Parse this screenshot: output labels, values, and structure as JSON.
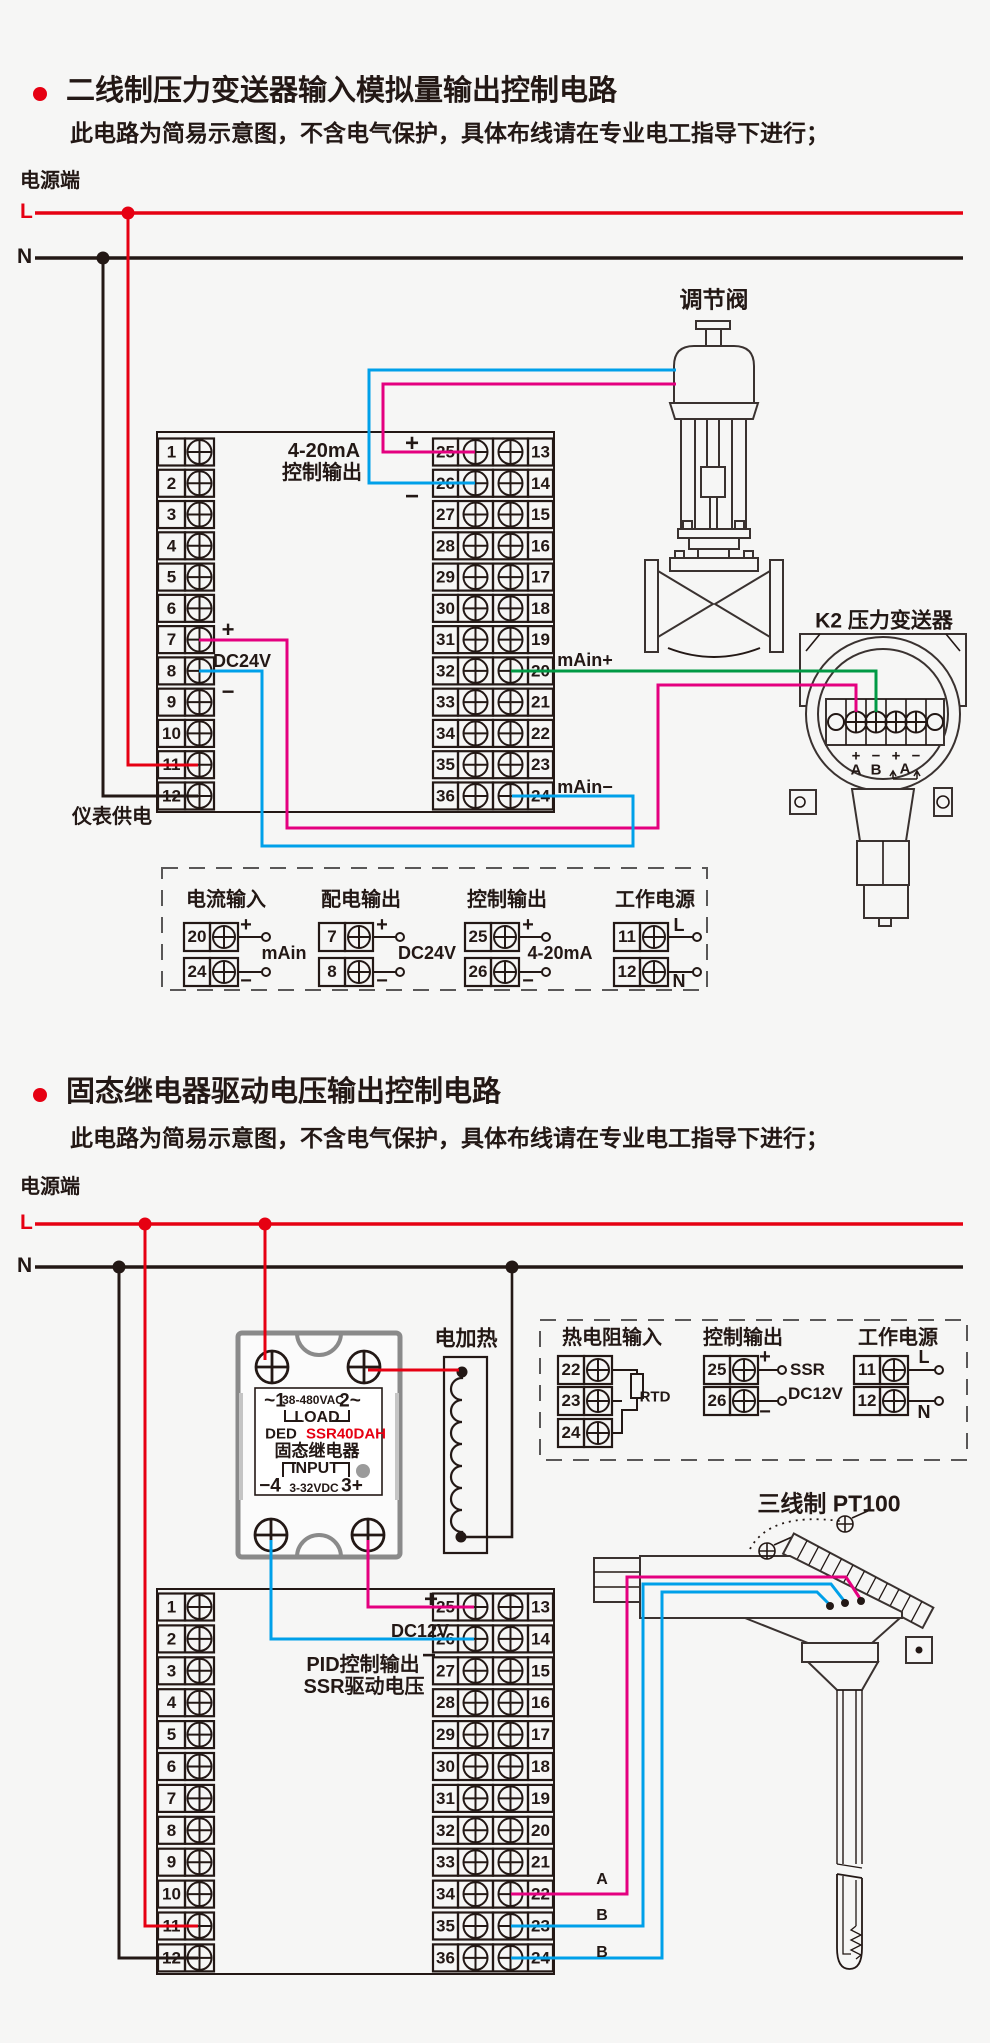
{
  "colors": {
    "line_red": "#e60012",
    "wire_magenta": "#e4007f",
    "wire_blue": "#00a0e9",
    "wire_green": "#009944",
    "ink": "#231815",
    "panel_gray": "#8a8a8a",
    "background": "#f6f6f5"
  },
  "terminal_numbers": {
    "left": [
      "1",
      "2",
      "3",
      "4",
      "5",
      "6",
      "7",
      "8",
      "9",
      "10",
      "11",
      "12"
    ],
    "mid": [
      "25",
      "26",
      "27",
      "28",
      "29",
      "30",
      "31",
      "32",
      "33",
      "34",
      "35",
      "36"
    ],
    "right": [
      "13",
      "14",
      "15",
      "16",
      "17",
      "18",
      "19",
      "20",
      "21",
      "22",
      "23",
      "24"
    ]
  },
  "s1": {
    "title": "二线制压力变送器输入模拟量输出控制电路",
    "note": "此电路为简易示意图，不含电气保护，具体布线请在专业电工指导下进行；",
    "power": "电源端",
    "l": "L",
    "n": "N",
    "out1": "4-20mA",
    "out2": "控制输出",
    "plus": "+",
    "minus": "−",
    "dc24v": "DC24V",
    "supply": "仪表供电",
    "main_plus": "mAin+",
    "main_minus": "mAin−",
    "valve": "调节阀",
    "tx": {
      "title": "K2 压力变送器",
      "p1": "+",
      "p2": "−",
      "p3": "+",
      "p4": "−",
      "a1": "A",
      "b": "B",
      "a2": "A"
    },
    "legend": {
      "g1": {
        "title": "电流输入",
        "r1n": "20",
        "r1s": "+",
        "r2n": "24",
        "r2s": "−",
        "name": "mAin"
      },
      "g2": {
        "title": "配电输出",
        "r1n": "7",
        "r1s": "+",
        "r2n": "8",
        "r2s": "−",
        "name": "DC24V"
      },
      "g3": {
        "title": "控制输出",
        "r1n": "25",
        "r1s": "+",
        "r2n": "26",
        "r2s": "−",
        "name": "4-20mA"
      },
      "g4": {
        "title": "工作电源",
        "r1n": "11",
        "r1s": "L",
        "r2n": "12",
        "r2s": "N"
      }
    }
  },
  "s2": {
    "title": "固态继电器驱动电压输出控制电路",
    "note": "此电路为简易示意图，不含电气保护，具体布线请在专业电工指导下进行；",
    "power": "电源端",
    "l": "L",
    "n": "N",
    "heater": "电加热",
    "ssr": {
      "t1": "~1",
      "vac": "38-480VAC",
      "t2": "2~",
      "load": "LOAD",
      "brand": "DED",
      "model": "SSR40DAH",
      "name": "固态继电器",
      "input": "INPUT",
      "t4": "−4",
      "vdc": "3-32VDC",
      "t3": "3+"
    },
    "plus": "+",
    "minus": "−",
    "dc12v": "DC12V",
    "pid1": "PID控制输出",
    "pid2": "SSR驱动电压",
    "wire_a": "A",
    "wire_b1": "B",
    "wire_b2": "B",
    "pt100": "三线制 PT100",
    "legend": {
      "g1": {
        "title": "热电阻输入",
        "r1n": "22",
        "r2n": "23",
        "r3n": "24",
        "name": "RTD"
      },
      "g2": {
        "title": "控制输出",
        "r1n": "25",
        "r1s": "+",
        "r2n": "26",
        "r2s": "−",
        "l1": "SSR",
        "l2": "DC12V"
      },
      "g3": {
        "title": "工作电源",
        "r1n": "11",
        "r1s": "L",
        "r2n": "12",
        "r2s": "N"
      }
    }
  }
}
